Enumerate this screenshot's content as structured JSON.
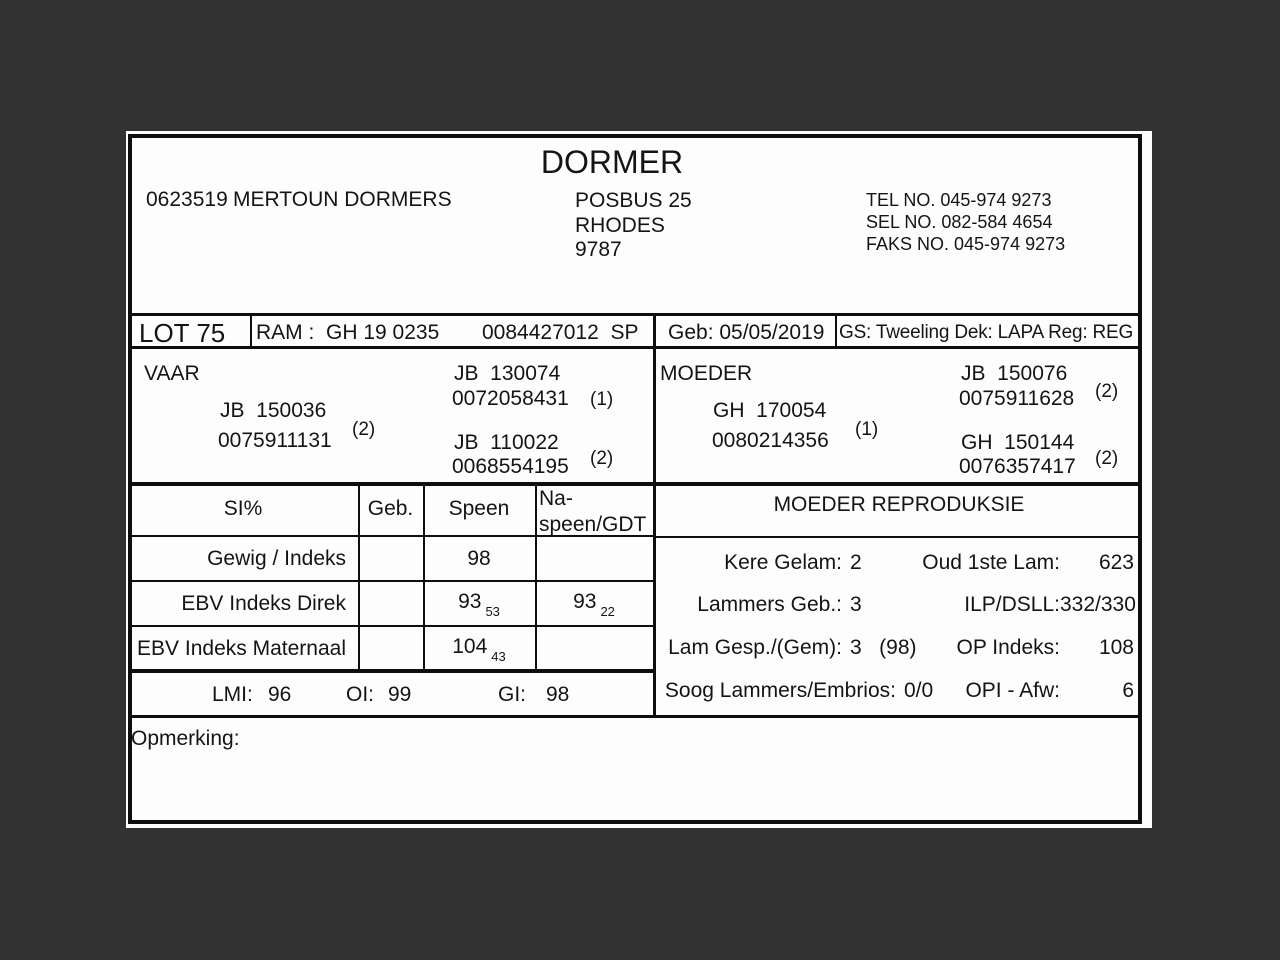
{
  "colors": {
    "surround": "#323232",
    "page": "#fdfdfd",
    "ink": "#0e0e0e"
  },
  "header": {
    "title": "DORMER",
    "breeder_no": "0623519",
    "breeder_name": "MERTOUN DORMERS",
    "address": [
      "POSBUS 25",
      "RHODES",
      "9787"
    ],
    "contact": [
      "TEL NO. 045-974 9273",
      "SEL NO. 082-584 4654",
      "FAKS NO. 045-974 9273"
    ]
  },
  "lot": {
    "lot_no": "LOT 75",
    "ram": "RAM :  GH 19 0235",
    "ram_reg": "0084427012  SP",
    "geb": "Geb: 05/05/2019",
    "gs": "GS: Tweeling Dek: LAPA Reg: REG"
  },
  "pedigree": {
    "vaar": {
      "label": "VAAR",
      "id": "JB  150036",
      "reg": "0075911131",
      "note": "(2)",
      "sire_id": "JB  130074",
      "sire_reg": "0072058431",
      "sire_note": "(1)",
      "dam_id": "JB  110022",
      "dam_reg": "0068554195",
      "dam_note": "(2)"
    },
    "moeder": {
      "label": "MOEDER",
      "id": "GH  170054",
      "reg": "0080214356",
      "note": "(1)",
      "sire_id": "JB  150076",
      "sire_reg": "0075911628",
      "sire_note": "(2)",
      "dam_id": "GH  150144",
      "dam_reg": "0076357417",
      "dam_note": "(2)"
    }
  },
  "si_table": {
    "headers": {
      "si": "SI%",
      "geb": "Geb.",
      "speen": "Speen",
      "naspeen": "Na-speen/GDT"
    },
    "rows": [
      {
        "label": "Gewig / Indeks",
        "geb": "",
        "speen": "98",
        "speen_sub": "",
        "naspeen": "",
        "naspeen_sub": ""
      },
      {
        "label": "EBV Indeks Direk",
        "geb": "",
        "speen": "93",
        "speen_sub": "53",
        "naspeen": "93",
        "naspeen_sub": "22"
      },
      {
        "label": "EBV Indeks Maternaal",
        "geb": "",
        "speen": "104",
        "speen_sub": "43",
        "naspeen": "",
        "naspeen_sub": ""
      }
    ],
    "footer": {
      "lmi_label": "LMI:",
      "lmi_value": "96",
      "oi_label": "OI:",
      "oi_value": "99",
      "gi_label": "GI:",
      "gi_value": "98"
    }
  },
  "reproduksie": {
    "title": "MOEDER REPRODUKSIE",
    "rows": [
      {
        "left_label": "Kere Gelam:",
        "left_value": "2",
        "right_label": "Oud 1ste Lam:",
        "right_value": "623"
      },
      {
        "left_label": "Lammers Geb.:",
        "left_value": "3",
        "right_label": "ILP/DSLL:",
        "right_value": "332/330"
      },
      {
        "left_label": "Lam Gesp./(Gem):",
        "left_value": "3   (98)",
        "right_label": "OP Indeks:",
        "right_value": "108"
      },
      {
        "left_label": "Soog Lammers/Embrios:",
        "left_value": "0/0",
        "right_label": "OPI - Afw:",
        "right_value": "6"
      }
    ]
  },
  "opmerking": {
    "label": "Opmerking:"
  }
}
